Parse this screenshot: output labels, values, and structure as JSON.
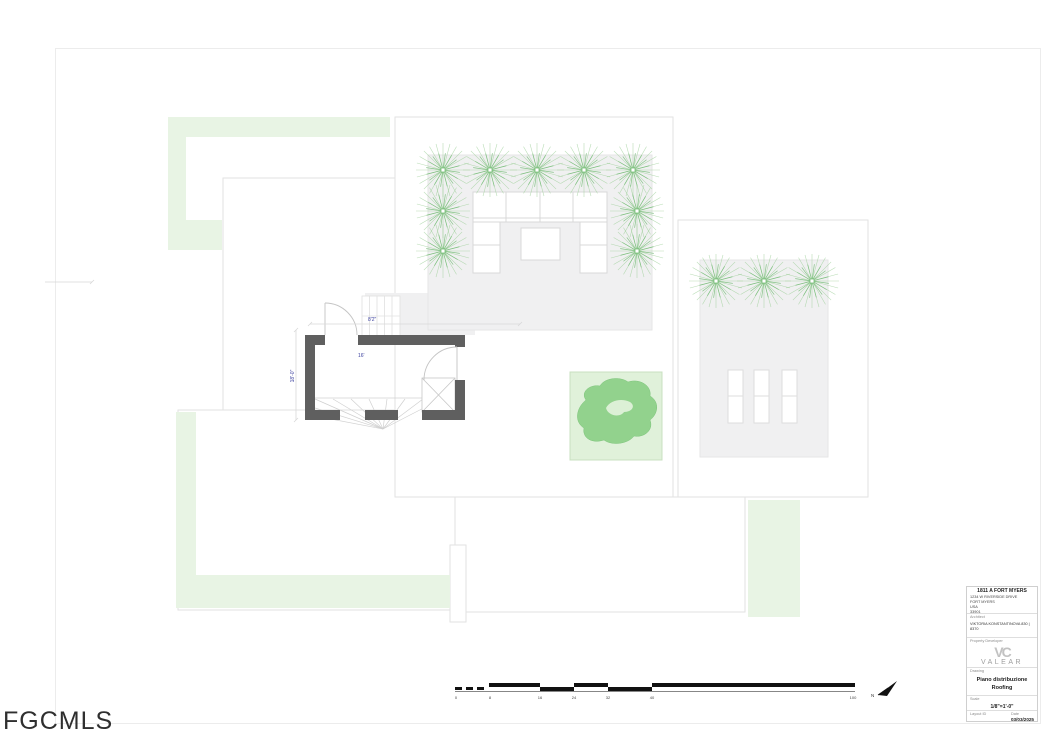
{
  "watermark": "FGCMLS",
  "title_block": {
    "project_name": "1811 A FORT MYERS",
    "address_line1": "1234 W RIVERSIDE DRIVE",
    "address_line2": "FORT MYERS",
    "address_line3": "USA",
    "address_line4": "33901",
    "architect_label": "Architect",
    "architect_value": "VIKTORIA KONSTANTINOVA 830 | 8370",
    "developer_label": "Property Developer",
    "logo_monogram": "VC",
    "logo_name": "VALEAR",
    "logo_subtitle": "CONCEPT",
    "drawing_label": "Drawing",
    "drawing_title1": "Piano distribuzione",
    "drawing_title2": "Roofing",
    "scale_label": "Scale",
    "scale_value": "1/8\"=1'-0\"",
    "layout_id_label": "Layout ID",
    "date_label": "Date",
    "date_value": "03/03/2025"
  },
  "plan_annotations": {
    "dim_width_top": "8'2\"",
    "dim_height_left": "18'-0\"",
    "dim_interior": "16'",
    "north_label": "N"
  },
  "scale_bar": {
    "labels": [
      "0",
      "8",
      "16",
      "24",
      "32",
      "40",
      "100"
    ]
  }
}
